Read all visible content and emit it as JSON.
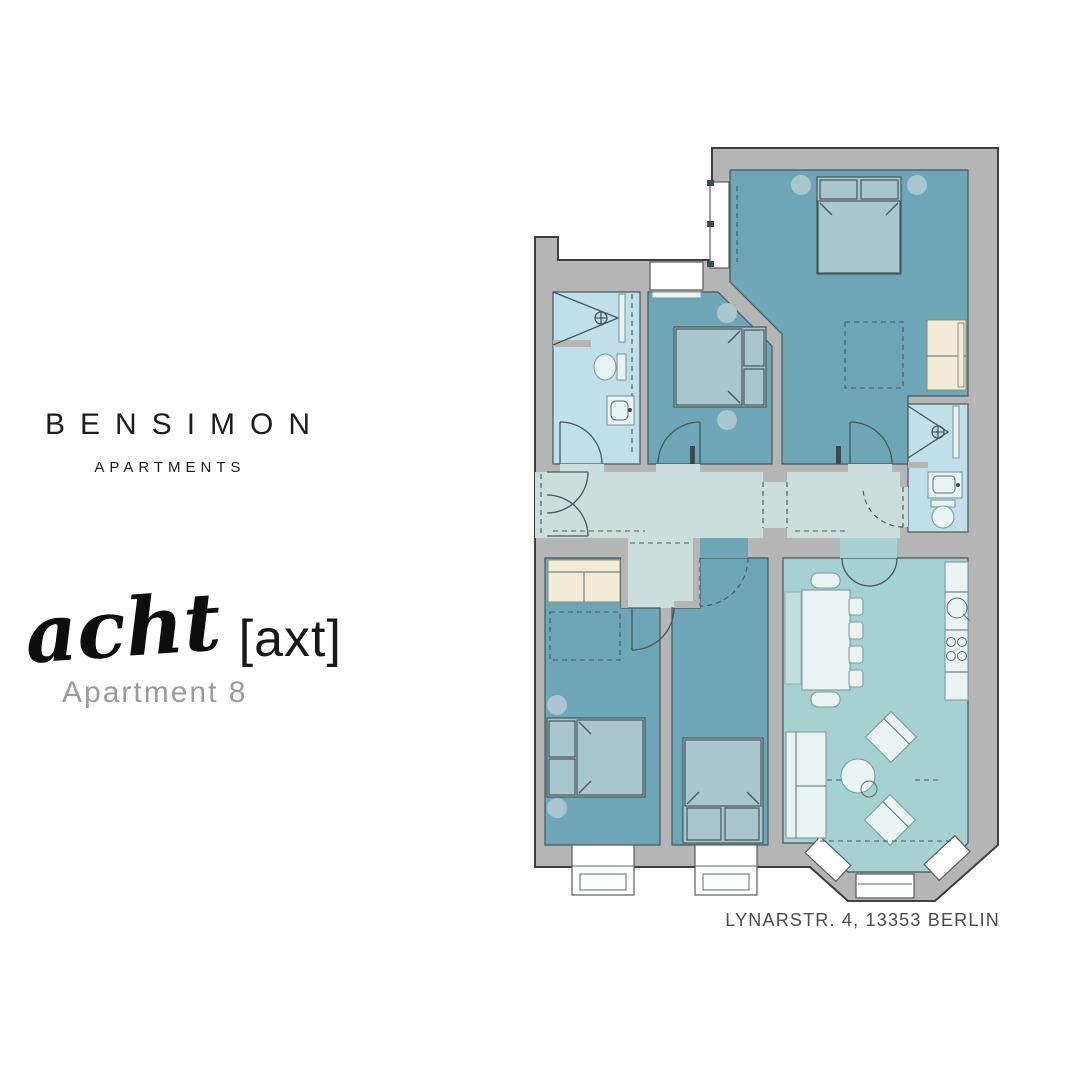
{
  "brand": {
    "name": "BENSIMON",
    "subtitle": "APARTMENTS"
  },
  "apartment": {
    "script_name": "acht",
    "phonetic": "[axt]",
    "label": "Apartment 8"
  },
  "address": "LYNARSTR. 4, 13353 BERLIN",
  "colors": {
    "wall": "#b5b5b5",
    "wall_outline": "#3f3f3f",
    "room_teal": "#6da7b7",
    "bathroom_blue": "#c0dfe9",
    "hallway_sage": "#cbdedb",
    "living_aqua": "#a6d1d1",
    "bed_fill": "#a9c5ce",
    "furniture_light": "#e9f3f1",
    "cream": "#f2ecd6",
    "circle_fill": "#a9c6ce",
    "line_dark": "#46555e",
    "text_dark": "#1c1c1c",
    "text_gray": "#9b9b9b",
    "address_gray": "#4a4a4a"
  }
}
